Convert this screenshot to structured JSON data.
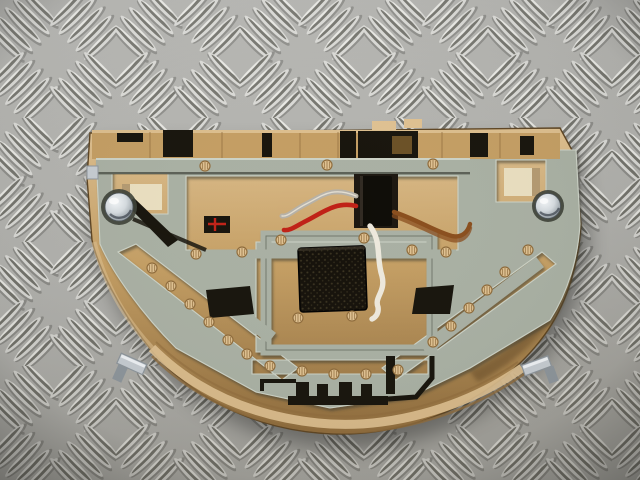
{
  "scene": {
    "type": "photograph",
    "subject": "car interior dome light / overhead console module, rear contact-plate side facing up",
    "surface": "aluminium diamond checker plate bench",
    "object_counts": {
      "chrome_screws": 2,
      "zinc_spring_clips": 2,
      "wires": 4,
      "bulb_sockets": 2
    },
    "wire_colors_visible": [
      "grey",
      "red",
      "white",
      "brown"
    ]
  },
  "colors": {
    "bench_base": "#b5b5b1",
    "bench_warm": "#a8a195",
    "rib_base": "#dededa",
    "rib_core": "#72726b",
    "rib_shadow": "#83837f",
    "rib_bright": "#f2f2ee",
    "housing": "#c49e63",
    "housing_light": "#dfc191",
    "housing_dark": "#8f6c3c",
    "housing_shadow": "#5e4523",
    "window_light": "#eadfc0",
    "busbar": "#a9b0a3",
    "busbar_light": "#ccd2c6",
    "busbar_dark": "#6e7468",
    "cut_shadow": "#3c4036",
    "foam": "#15110a",
    "foam_dot": "#3a3320",
    "connector": "#0e0c07",
    "cavity": "#1c1710",
    "black_part": "#17140c",
    "amber_recess": "#7a5a2c",
    "wire_red": "#c02217",
    "wire_grey": "#b6b1a7",
    "wire_white": "#ede8dc",
    "wire_brown": "#8a4e1d",
    "chrome_hi": "#f4f7f9",
    "chrome_mid": "#d6dce0",
    "chrome_dark": "#5f686e",
    "zinc": "#c6ccd1",
    "zinc_dark": "#8d959b",
    "shadow": "#000000"
  }
}
